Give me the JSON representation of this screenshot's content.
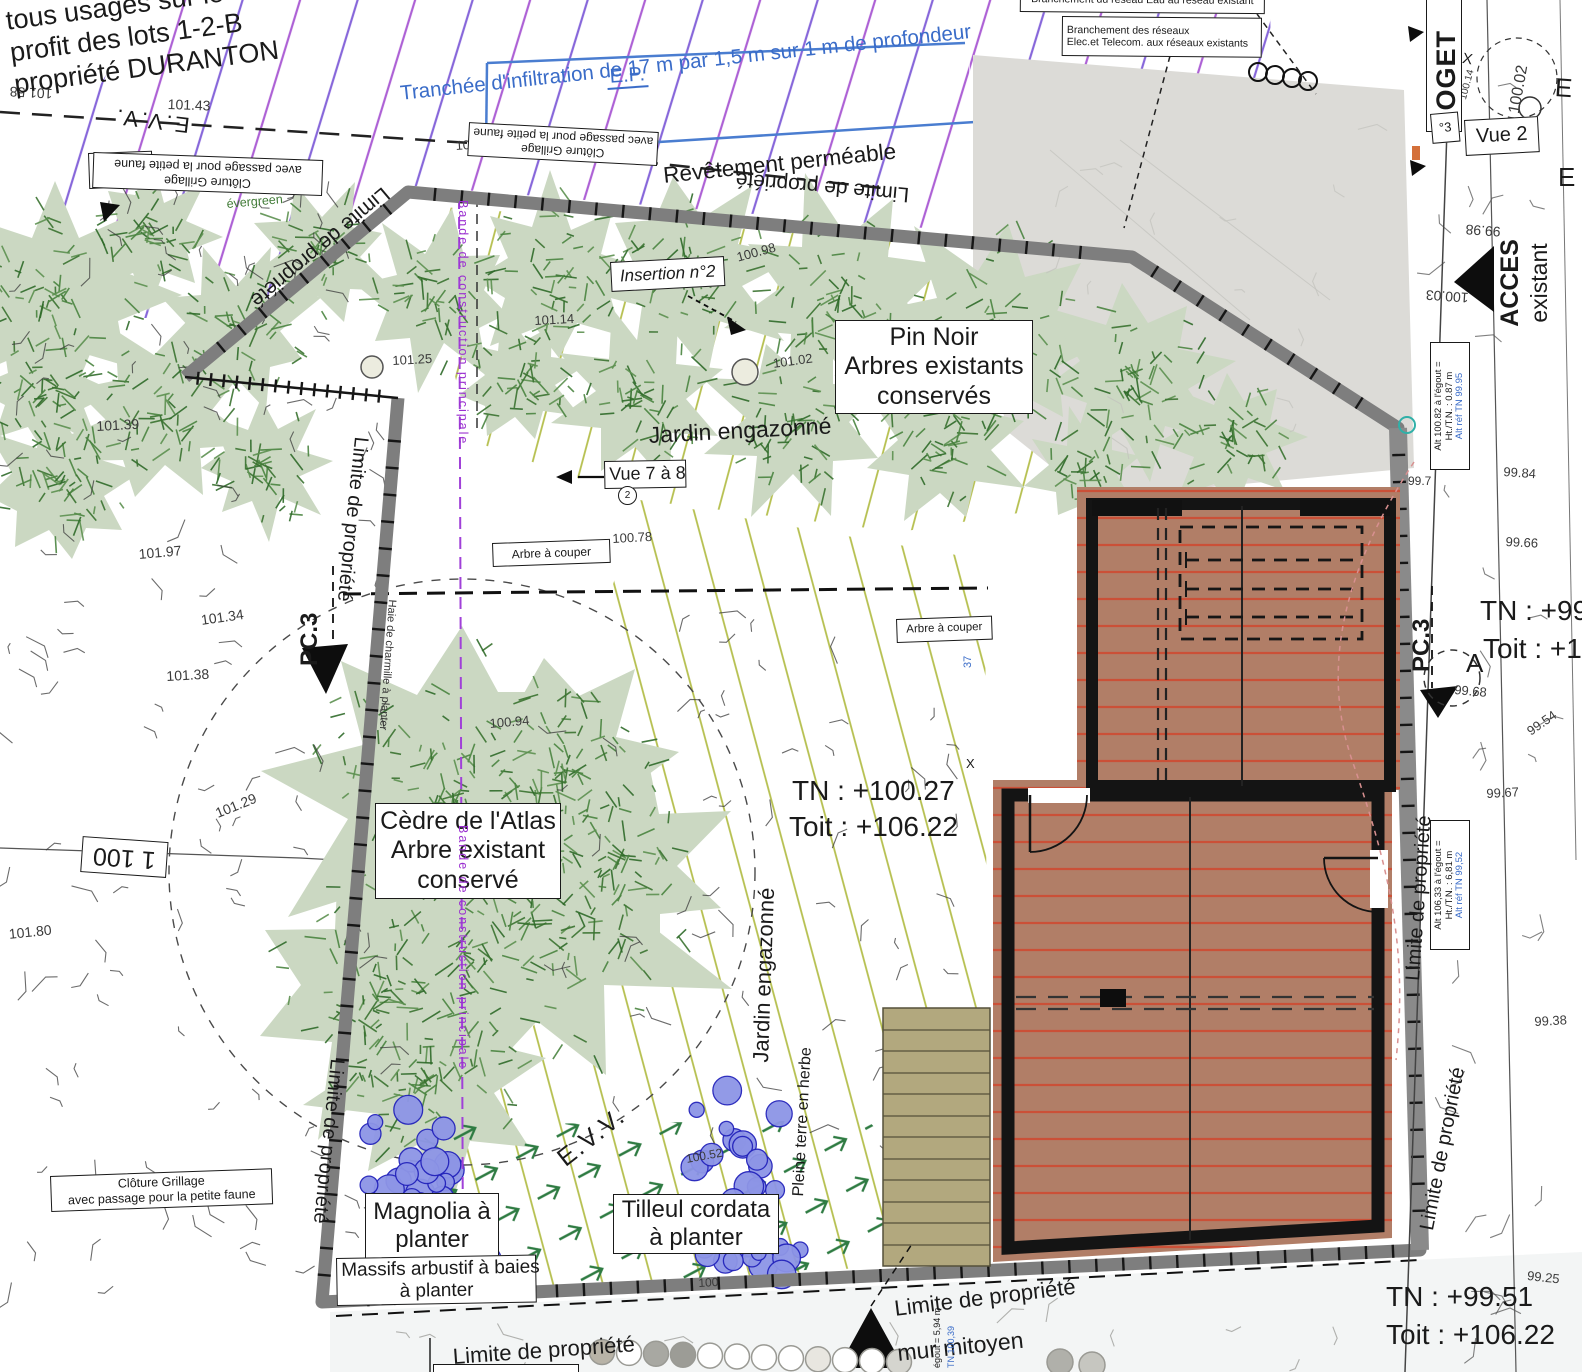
{
  "repeated": {
    "limite_propriete": "Limite de propriété",
    "cloture_l1": "Clôture Grillage",
    "cloture_l2": "avec passage pour la petite faune",
    "evv": "E.V.V.",
    "pc3": "PC.3",
    "jardin_engazonne": "Jardin engazonné",
    "arbre_a_couper": "Arbre à couper"
  },
  "notes": {
    "servitude_1": "tous usages sur le lot A",
    "servitude_2": "profit des lots 1-2-B",
    "servitude_3": "propriété DURANTON",
    "trench_ep": "E.P.",
    "trench_desc": "Tranchée d'infiltration de 17 m par 1,5 m sur 1 m de profondeur",
    "revetement": "Revêtement perméable",
    "branchement_eau": "Branchement du réseau Eau au réseau existant",
    "branchement_rx_1": "Branchement des réseaux",
    "branchement_rx_2": "Elec.et Telecom. aux réseaux existants",
    "evergreen": "évergreen",
    "bande_construction": "Bande de construction principale",
    "haie": "Haie de charmille à planter",
    "pleine_terre": "Pleine terre en herbe",
    "mur_mitoyen": "mur mitoyen",
    "acces_1": "ACCES",
    "acces_2": "existant",
    "loget": "LOGET",
    "letter_a": "A",
    "x_mark": "X",
    "deg3": "°3",
    "e_frag": "E"
  },
  "views": {
    "vue11": "Vue 11",
    "vue2": "Vue 2",
    "vue78": "Vue 7 à 8",
    "insertion2": "Insertion n°2",
    "circ2": "2"
  },
  "plants": {
    "pin_1": "Pin Noir",
    "pin_2": "Arbres existants",
    "pin_3": "conservés",
    "cedre_1": "Cèdre de l'Atlas",
    "cedre_2": "Arbre existant",
    "cedre_3": "conservé",
    "magnolia_1": "Magnolia à",
    "magnolia_2": "planter",
    "tilleul_1": "Tilleul cordata",
    "tilleul_2": "à planter",
    "massifs_1": "Massifs arbustif à baies",
    "massifs_2": "à planter"
  },
  "levels": {
    "tn_center": "TN : +100.27",
    "toit_center": "Toit :  +106.22",
    "tn_bottom": "TN : +99.51",
    "toit_bottom": "Toit :  +106.22",
    "tn_right": "TN : +99.",
    "toit_right": "Toit :  +10"
  },
  "alt_boxes": {
    "b1_1": "Alt 100.82 à l'égout =",
    "b1_2": "Ht./T.N. : 0.87 m",
    "b1_3": "Alt réf TN 99.95",
    "b2_1": "Alt 106,33 à l'égout =",
    "b2_2": "Ht./T.N. : 6,81 m",
    "b2_3": "Alt réf TN 99,52",
    "frag_a": "égout = 5,94 m",
    "frag_b": "TN 100,39"
  },
  "scale_label": "1 100",
  "colors": {
    "boundary": "#7e7e7e",
    "blue_note": "#3a6cc8",
    "purple_line": "#a040d8",
    "hatch_violet": "#7a56d6",
    "hatch_magenta": "#a44fd0",
    "hatch_olive": "#b5bf4e",
    "roof_fill": "#b17e67",
    "roof_line": "#cf4b32",
    "tree_fill": "#cbd8c2",
    "shrub_fill": "#8d95e6",
    "driveway": "#dcdbd7",
    "stairs": "#b2a87e"
  },
  "spots": [
    {
      "v": "101.58",
      "x": 52,
      "y": 102,
      "r": 183,
      "s": 14
    },
    {
      "v": "101.43",
      "x": 168,
      "y": 96,
      "r": 2,
      "s": 14
    },
    {
      "v": "101.12",
      "x": 455,
      "y": 138,
      "r": -4,
      "s": 13
    },
    {
      "v": "101.39",
      "x": 96,
      "y": 418,
      "r": -3,
      "s": 14
    },
    {
      "v": "101.97",
      "x": 138,
      "y": 546,
      "r": -5,
      "s": 14
    },
    {
      "v": "101.34",
      "x": 200,
      "y": 612,
      "r": -8,
      "s": 14
    },
    {
      "v": "101.38",
      "x": 166,
      "y": 668,
      "r": -3,
      "s": 14
    },
    {
      "v": "101.29",
      "x": 213,
      "y": 806,
      "r": -22,
      "s": 14
    },
    {
      "v": "101.80",
      "x": 8,
      "y": 926,
      "r": -6,
      "s": 14
    },
    {
      "v": "100.98",
      "x": 735,
      "y": 250,
      "r": -15,
      "s": 13
    },
    {
      "v": "101.14",
      "x": 534,
      "y": 313,
      "r": -3,
      "s": 13
    },
    {
      "v": "101.25",
      "x": 392,
      "y": 353,
      "r": -3,
      "s": 13
    },
    {
      "v": "101.02",
      "x": 772,
      "y": 356,
      "r": -8,
      "s": 13
    },
    {
      "v": "100.78",
      "x": 612,
      "y": 531,
      "r": -3,
      "s": 13
    },
    {
      "v": "100.94",
      "x": 489,
      "y": 716,
      "r": -5,
      "s": 13
    },
    {
      "v": "100.52",
      "x": 685,
      "y": 1152,
      "r": -10,
      "s": 12
    },
    {
      "v": "100",
      "x": 698,
      "y": 1276,
      "r": -3,
      "s": 12
    },
    {
      "v": "99.98",
      "x": 1500,
      "y": 240,
      "r": 184,
      "s": 14
    },
    {
      "v": "100.03",
      "x": 1468,
      "y": 306,
      "r": 184,
      "s": 14
    },
    {
      "v": "100.14",
      "x": 1458,
      "y": 98,
      "r": -75,
      "s": 10
    },
    {
      "v": "100.02",
      "x": 1506,
      "y": 112,
      "r": -80,
      "s": 16
    },
    {
      "v": "99.84",
      "x": 1504,
      "y": 464,
      "r": 4,
      "s": 13
    },
    {
      "v": "99.7",
      "x": 1408,
      "y": 474,
      "r": 0,
      "s": 12
    },
    {
      "v": "99.66",
      "x": 1506,
      "y": 534,
      "r": 3,
      "s": 13
    },
    {
      "v": "99.68",
      "x": 1455,
      "y": 682,
      "r": 5,
      "s": 13
    },
    {
      "v": "99.54",
      "x": 1524,
      "y": 726,
      "r": -35,
      "s": 13
    },
    {
      "v": "99.67",
      "x": 1486,
      "y": 786,
      "r": -3,
      "s": 13
    },
    {
      "v": "99.38",
      "x": 1534,
      "y": 1014,
      "r": -3,
      "s": 13
    },
    {
      "v": "99.25",
      "x": 1528,
      "y": 1268,
      "r": 6,
      "s": 13
    },
    {
      "v": "37",
      "x": 962,
      "y": 668,
      "r": -90,
      "s": 11,
      "c": "#3a6cc8"
    }
  ]
}
